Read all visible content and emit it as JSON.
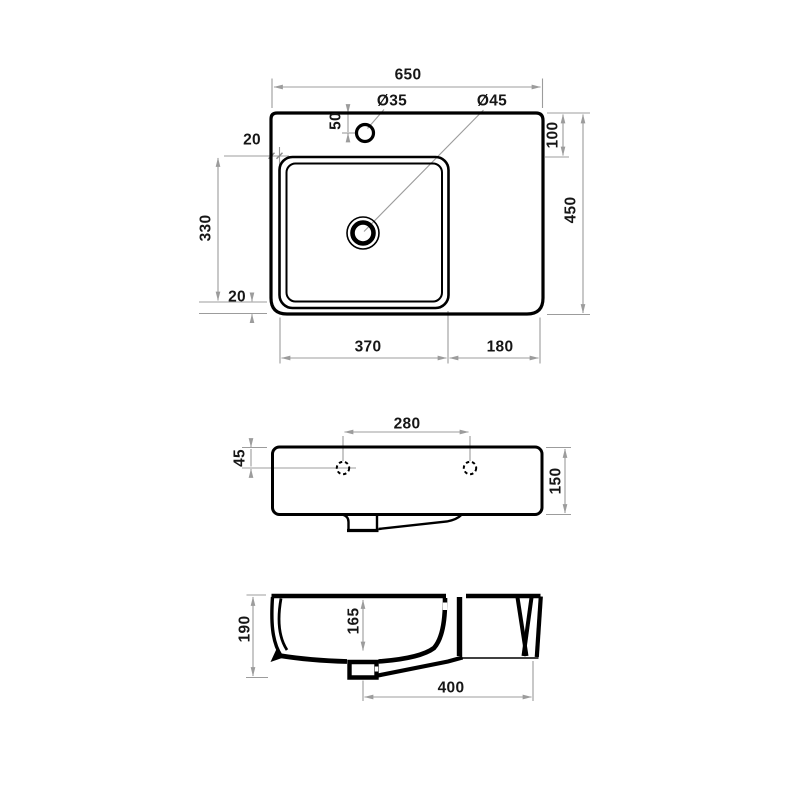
{
  "colors": {
    "background": "#ffffff",
    "part_line": "#000000",
    "dimension_line": "#9c9c9c",
    "text": "#161616"
  },
  "labels": {
    "top": {
      "overall_width": "650",
      "faucet_hole_dia": "Ø35",
      "drain_hole_dia": "Ø45",
      "faucet_offset": "50",
      "left_gap": "20",
      "basin_length": "330",
      "bottom_gap": "20",
      "top_edge_to_basin": "100",
      "overall_depth": "450",
      "basin_width": "370",
      "right_shelf": "180"
    },
    "front": {
      "hole_spacing": "280",
      "hole_drop": "45",
      "overall_height": "150"
    },
    "section": {
      "overall_height": "190",
      "bowl_depth": "165",
      "drain_to_edge": "400"
    }
  }
}
